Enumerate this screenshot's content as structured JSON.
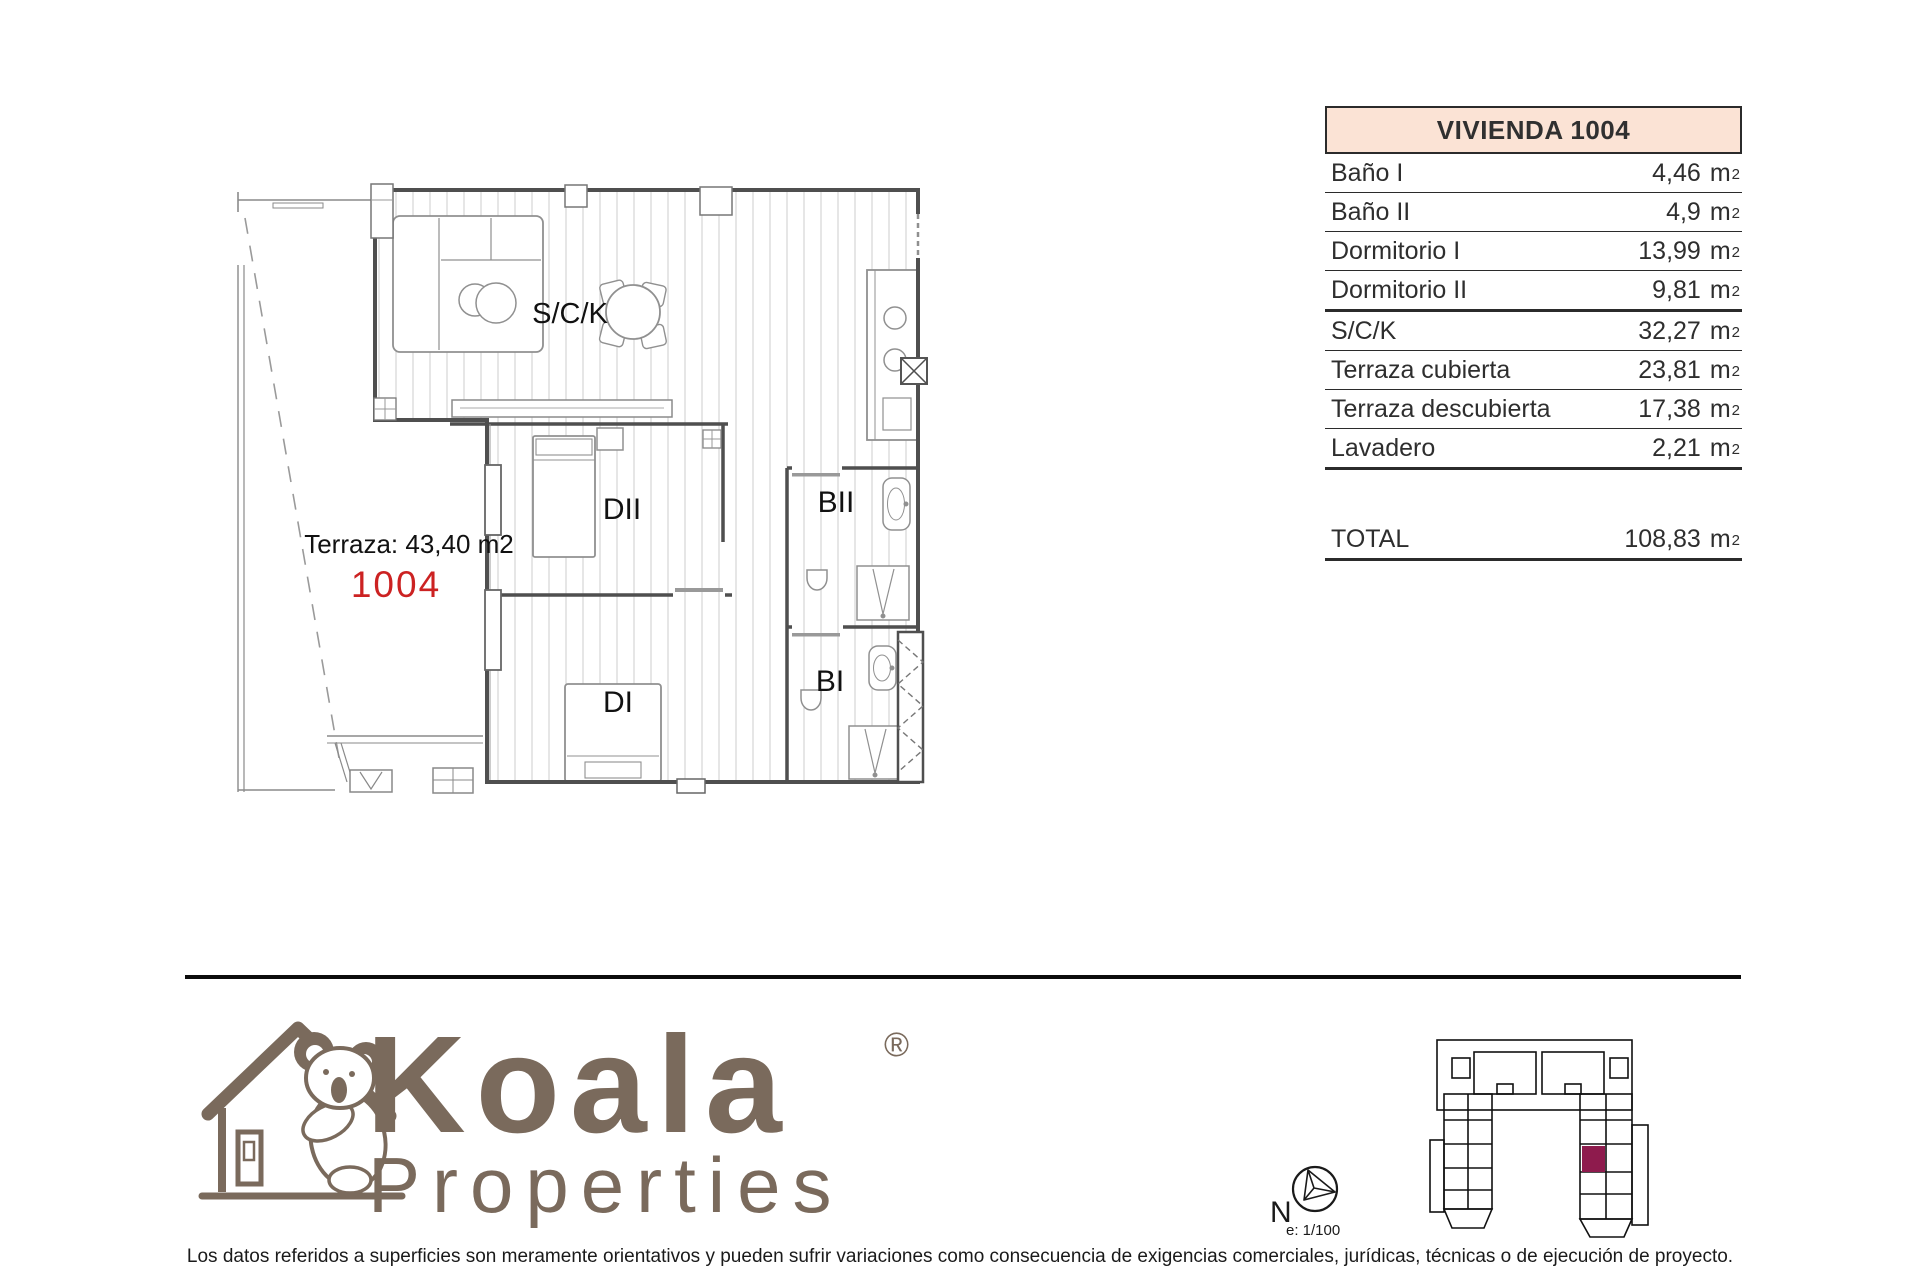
{
  "floor_plan": {
    "terrace_label": "Terraza: 43,40 m2",
    "unit_number": "1004",
    "unit_number_color": "#cc2222",
    "labels": {
      "living": "S/C/K",
      "bedroom2": "DII",
      "bath2": "BII",
      "bedroom1": "DI",
      "bath1": "BI"
    }
  },
  "area_table": {
    "title": "VIVIENDA 1004",
    "header_bg": "#fbe3d5",
    "unit": "m",
    "sup": "2",
    "rows": [
      {
        "label": "Baño I",
        "value": "4,46"
      },
      {
        "label": "Baño II",
        "value": "4,9"
      },
      {
        "label": "Dormitorio I",
        "value": "13,99"
      },
      {
        "label": "Dormitorio II",
        "value": "9,81"
      },
      {
        "label": "S/C/K",
        "value": "32,27"
      },
      {
        "label": "Terraza cubierta",
        "value": "23,81"
      },
      {
        "label": "Terraza descubierta",
        "value": "17,38"
      },
      {
        "label": "Lavadero",
        "value": "2,21"
      }
    ],
    "total_label": "TOTAL",
    "total_value": "108,83"
  },
  "branding": {
    "name": "Koala",
    "subtitle": "Properties",
    "registered": "®",
    "color": "#7a6a5c"
  },
  "compass": {
    "north_label": "N",
    "scale_label": "e: 1/100"
  },
  "locator": {
    "highlight_color": "#8e1b4d"
  },
  "footer": {
    "disclaimer": "Los datos referidos a superficies son meramente orientativos y pueden sufrir variaciones como consecuencia de exigencias comerciales, jurídicas, técnicas o de ejecución de proyecto."
  }
}
